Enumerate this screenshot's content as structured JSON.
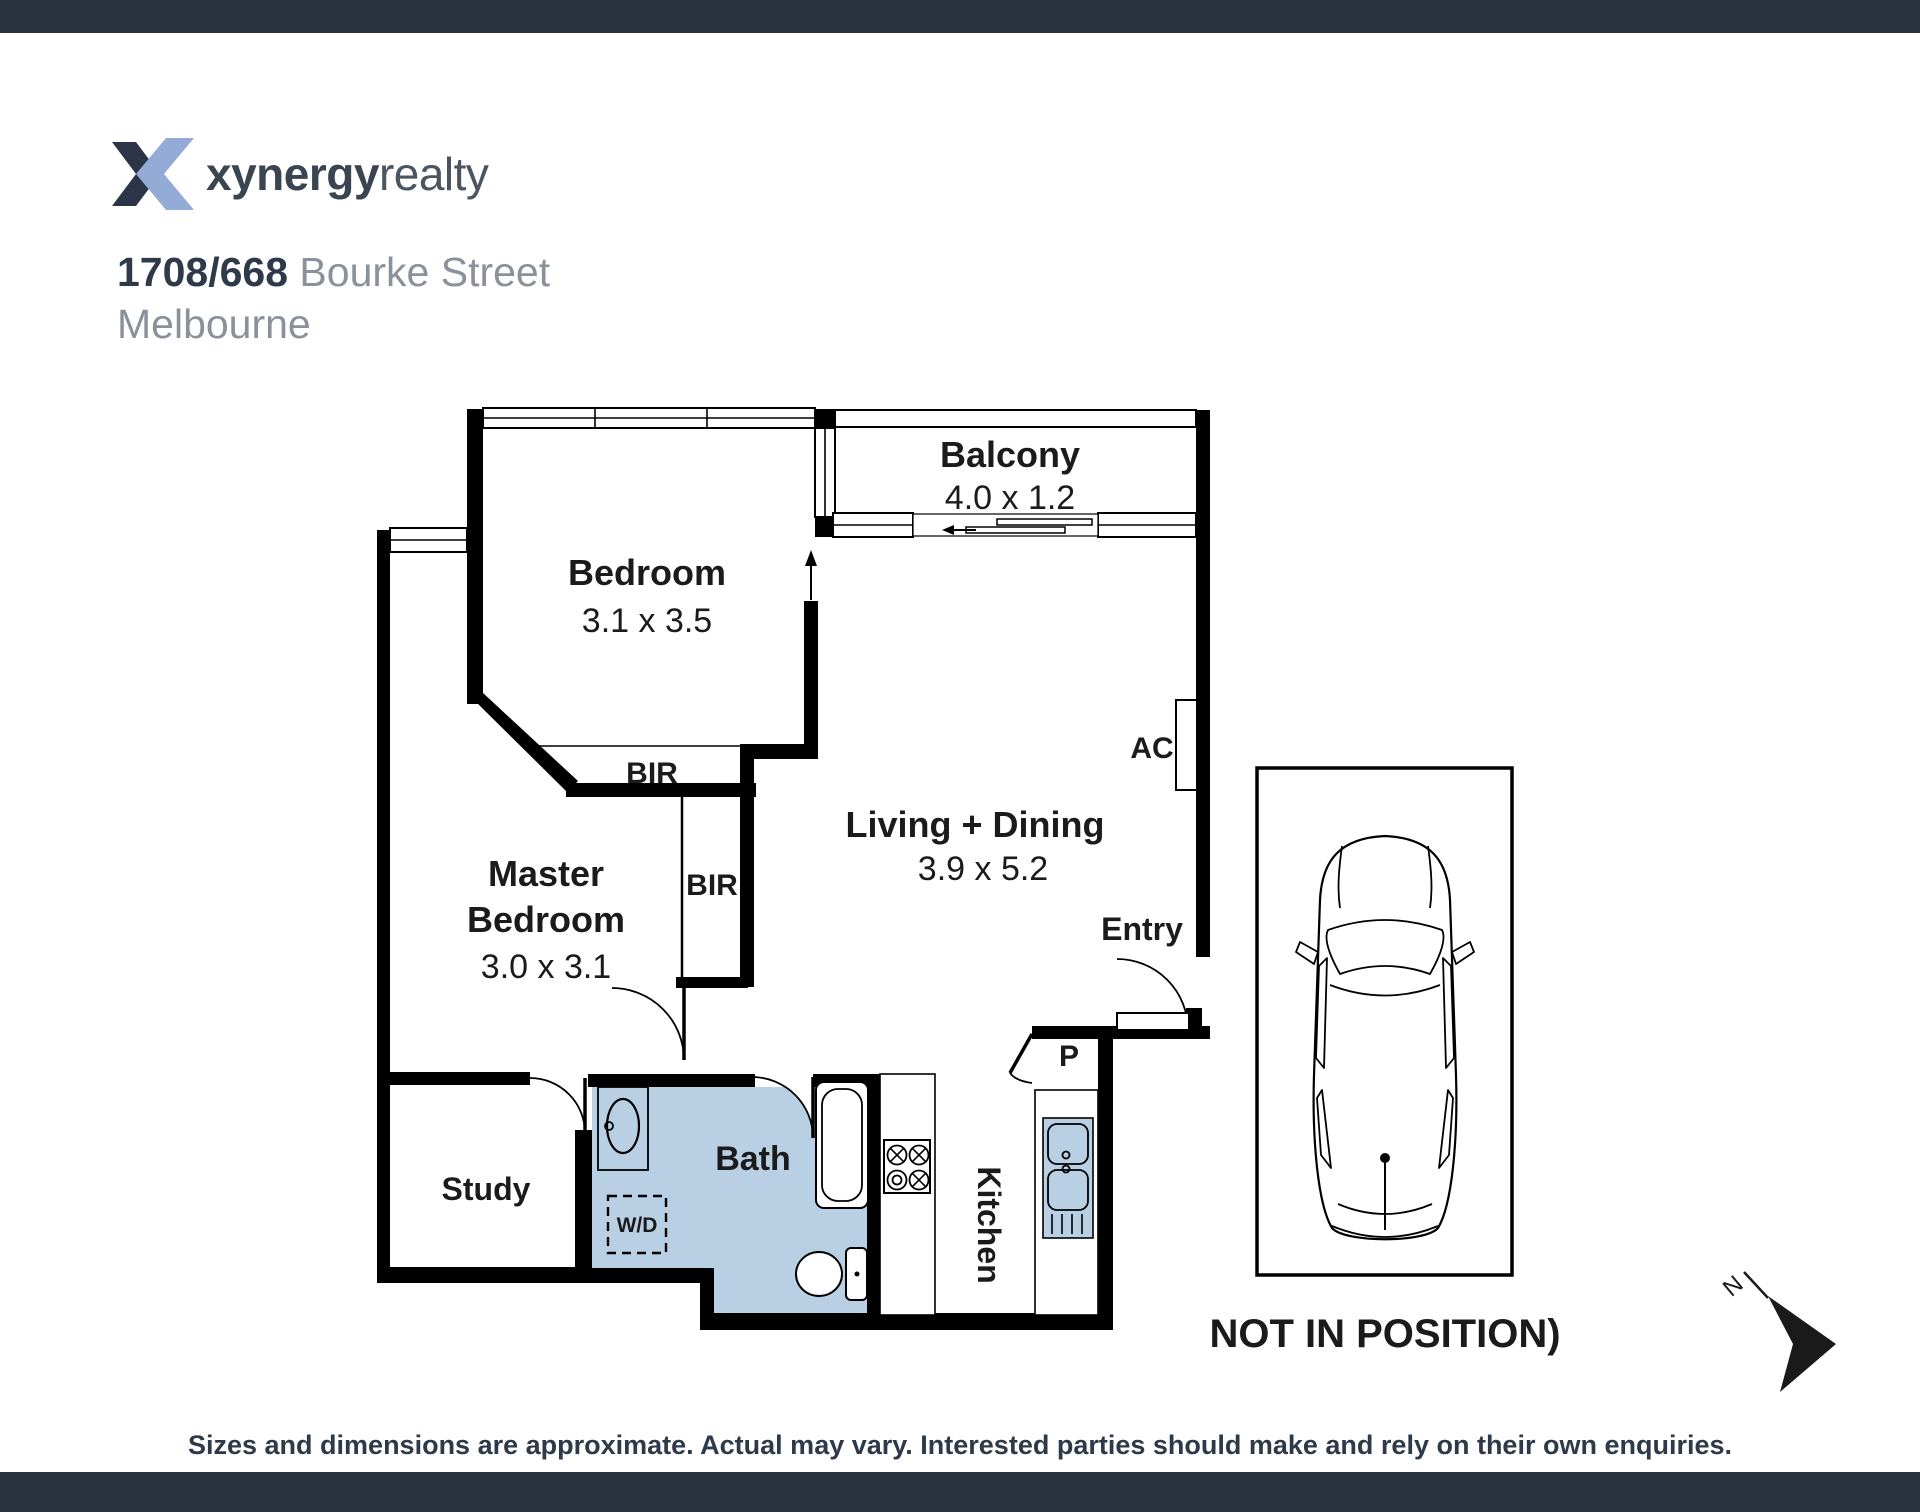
{
  "page": {
    "background": "#ffffff",
    "bar_color": "#2a323e"
  },
  "brand": {
    "name_bold": "xynergy",
    "name_light": "realty",
    "logo_dark_color": "#2b3547",
    "logo_blue_color": "#94aad7"
  },
  "listing": {
    "unit": "1708/668",
    "street": "Bourke Street",
    "city": "Melbourne"
  },
  "plan": {
    "fixture_color": "#b9cfe4",
    "rooms": [
      {
        "id": "bedroom",
        "name": "Bedroom",
        "dims": "3.1 x 3.5"
      },
      {
        "id": "balcony",
        "name": "Balcony",
        "dims": "4.0 x 1.2"
      },
      {
        "id": "living",
        "name": "Living + Dining",
        "dims": "3.9 x 5.2"
      },
      {
        "id": "master",
        "name_line1": "Master",
        "name_line2": "Bedroom",
        "dims": "3.0 x 3.1"
      },
      {
        "id": "study",
        "name": "Study"
      },
      {
        "id": "bath",
        "name": "Bath"
      },
      {
        "id": "kitchen",
        "name": "Kitchen"
      }
    ],
    "labels": {
      "bir": "BIR",
      "ac": "AC",
      "entry": "Entry",
      "pantry": "P",
      "wd": "W/D",
      "north": "N"
    },
    "car_note": "NOT IN POSITION)"
  },
  "footer": {
    "disclaimer": "Sizes and dimensions are approximate. Actual may vary. Interested parties should make and rely on their own enquiries."
  }
}
